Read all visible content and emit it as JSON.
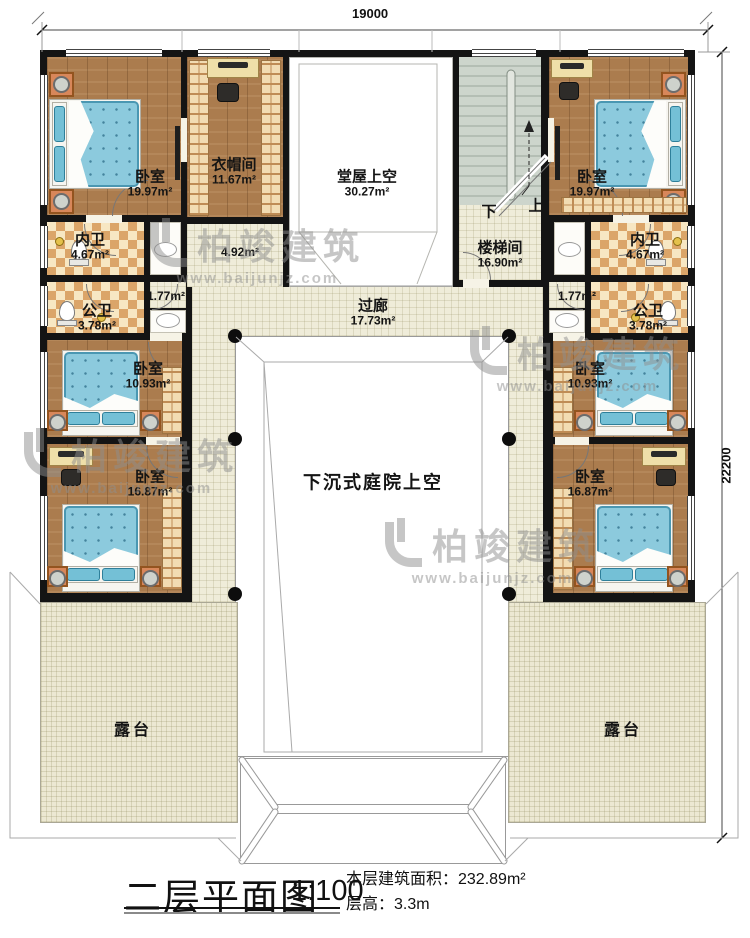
{
  "title_block": {
    "title": "二层平面图",
    "scale": "1:100",
    "building_area": "本层建筑面积：232.89m²",
    "floor_height": "层高：3.3m"
  },
  "dimensions": {
    "top_width": "19000",
    "right_height": "22200"
  },
  "watermark": {
    "brand": "柏竣建筑",
    "url": "www.baijunjz.com"
  },
  "stairs": {
    "down_label": "下",
    "up_label": "上"
  },
  "rooms": {
    "bedroom_tl": {
      "name": "卧室",
      "area": "19.97m²"
    },
    "cloakroom": {
      "name": "衣帽间",
      "area": "11.67m²"
    },
    "hall_void": {
      "name": "堂屋上空",
      "area": "30.27m²"
    },
    "stairwell": {
      "name": "楼梯间",
      "area": "16.90m²"
    },
    "bedroom_tr": {
      "name": "卧室",
      "area": "19.97m²"
    },
    "inner_bath_left": {
      "name": "内卫",
      "area": "4.67m²"
    },
    "inner_bath_right": {
      "name": "内卫",
      "area": "4.67m²"
    },
    "lobby_left": {
      "area": "4.92m²"
    },
    "vestibule_left": {
      "area": "1.77m²"
    },
    "vestibule_right": {
      "area": "1.77m²"
    },
    "public_bath_left": {
      "name": "公卫",
      "area": "3.78m²"
    },
    "public_bath_right": {
      "name": "公卫",
      "area": "3.78m²"
    },
    "bedroom_ml": {
      "name": "卧室",
      "area": "10.93m²"
    },
    "bedroom_mr": {
      "name": "卧室",
      "area": "10.93m²"
    },
    "bedroom_bl": {
      "name": "卧室",
      "area": "16.87m²"
    },
    "bedroom_br": {
      "name": "卧室",
      "area": "16.87m²"
    },
    "corridor": {
      "name": "过廊",
      "area": "17.73m²"
    },
    "courtyard_void": {
      "name": "下沉式庭院上空"
    },
    "terrace_left": {
      "name": "露台"
    },
    "terrace_right": {
      "name": "露台"
    }
  },
  "colors": {
    "wall": "#141414",
    "wood_floor": "#ab7c4e",
    "tile_accent": "#dba569",
    "floor_cream": "#efecd9",
    "mattress_blue": "#8ccadd",
    "stair_gray": "#cdd5cc"
  }
}
